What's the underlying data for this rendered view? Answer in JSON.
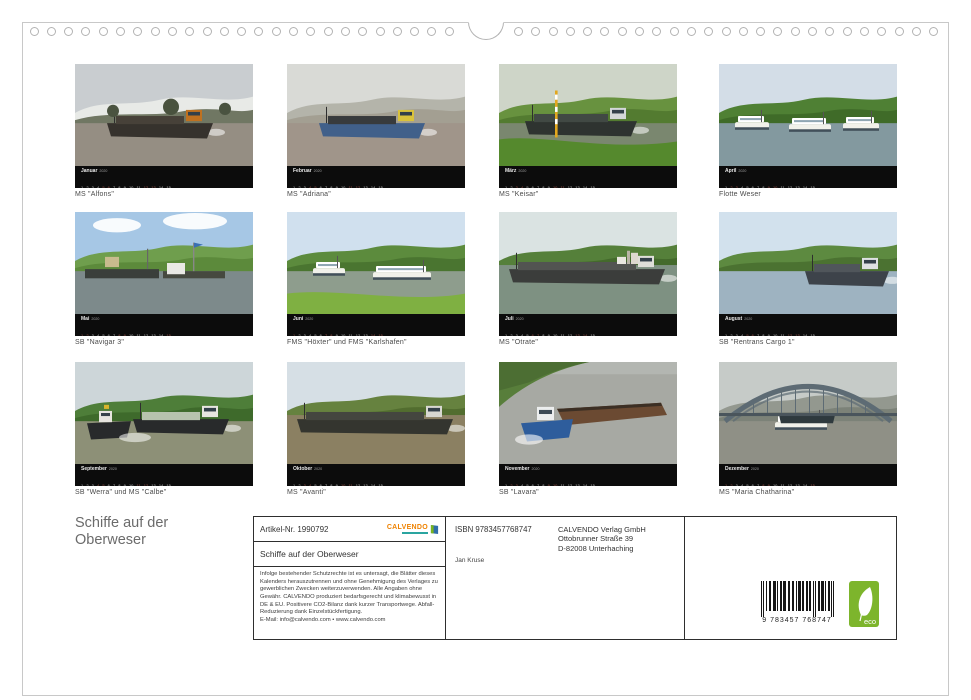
{
  "page": {
    "title_line1": "Schiffe auf der",
    "title_line2": "Oberweser"
  },
  "calendar": {
    "year": "2020"
  },
  "thumbnails": [
    {
      "month": "Januar",
      "caption": "MS \"Alfons\"",
      "type": "ship",
      "extra": "trees",
      "sky": "#c9cdd0",
      "hill": "#e8eae7",
      "hill2": "#707763",
      "water": "#958e83",
      "hull": "#36322d",
      "cab": "#bf7120",
      "cargo": "#474139"
    },
    {
      "month": "Februar",
      "caption": "MS \"Adriana\"",
      "type": "ship",
      "sky": "#d9dad6",
      "hill": "#b4b4aa",
      "hill2": "#a39f92",
      "water": "#a0958a",
      "hull": "#41608a",
      "cab": "#d9c23b",
      "cargo": "#383b3d"
    },
    {
      "month": "März",
      "caption": "MS \"Keisar\"",
      "type": "pole",
      "sky": "#ced5c8",
      "hill": "#68923f",
      "hill2": "#537b30",
      "water": "#7a876f",
      "hull": "#2e3330",
      "cab": "#d3d7d8",
      "cargo": "#414944",
      "fg": "#55892d"
    },
    {
      "month": "April",
      "caption": "Flotte Weser",
      "type": "white",
      "sky": "#d3dde7",
      "hill": "#4f8034",
      "hill2": "#3f6b28",
      "water": "#83999f",
      "hull": "#f0f0ea",
      "cab": "#ffffff",
      "cargo": "#d9d4c6"
    },
    {
      "month": "Mai",
      "caption": "SB \"Navigar 3\"",
      "type": "pontoon",
      "sky": "#a6c7e5",
      "hill": "#6f9e4d",
      "hill2": "#5c8a3b",
      "water": "#7d8a8b",
      "hull": "#3a3f3b",
      "cab": "#e9e9e4",
      "cargo": "#8a6f3f"
    },
    {
      "month": "Juni",
      "caption": "FMS \"Höxter\" und FMS \"Karlshafen\"",
      "type": "two",
      "sky": "#d0e0ee",
      "hill": "#5c8b3d",
      "hill2": "#4a7530",
      "water": "#8e9d8d",
      "hull": "#eae9e1",
      "cab": "#f4f4ee",
      "cargo": "#b7b19a",
      "fg": "#7fb042"
    },
    {
      "month": "Juli",
      "caption": "MS \"Otrate\"",
      "type": "long",
      "extra": "buildings",
      "sky": "#dae3e2",
      "hill": "#55803a",
      "hill2": "#446a2c",
      "water": "#7e9182",
      "hull": "#3b3d3b",
      "cab": "#dfdfd9",
      "cargo": "#525451"
    },
    {
      "month": "August",
      "caption": "SB \"Rentrans Cargo 1\"",
      "type": "shipRight",
      "sky": "#d2e1ed",
      "hill": "#5d8a40",
      "hill2": "#4b7231",
      "water": "#9eb3c1",
      "hull": "#3d434a",
      "cab": "#dde1e2",
      "cargo": "#50565b"
    },
    {
      "month": "September",
      "caption": "SB \"Werra\" und MS \"Calbe\"",
      "type": "tugship",
      "sky": "#cdd6d9",
      "hill": "#4e7e39",
      "hill2": "#3e6a2b",
      "water": "#8d9077",
      "hull": "#282a2b",
      "cab": "#e7e5df",
      "cargo": "#b7c3ae"
    },
    {
      "month": "Oktober",
      "caption": "MS \"Avanti\"",
      "type": "long",
      "sky": "#d6dfe5",
      "hill": "#66823f",
      "hill2": "#526d2f",
      "water": "#8b8062",
      "hull": "#34352f",
      "cab": "#d8d8d1",
      "cargo": "#44463f"
    },
    {
      "month": "November",
      "caption": "SB \"Lavara\"",
      "type": "tugbarge",
      "sky": "#b3b6b1",
      "hill": "#587e3b",
      "hill2": "#4c6e33",
      "water": "#a7a9a3",
      "hull": "#2e5d9c",
      "cab": "#eceeee",
      "cargo": "#6b4a32"
    },
    {
      "month": "Dezember",
      "caption": "MS \"Maria Chatharina\"",
      "type": "bridge",
      "sky": "#c6cbc8",
      "hill": "#93988f",
      "hill2": "#7c8278",
      "water": "#8f9086",
      "hull": "#3a3d3a",
      "cab": "#e9e9e3",
      "cargo": "#323d41",
      "bridge": "#5d6b74"
    }
  ],
  "info_box": {
    "artikel": "Artikel-Nr. 1990792",
    "calvendo_logo": "CALVENDO",
    "title": "Schiffe auf der Oberweser",
    "legal": "Infolge bestehender Schutzrechte ist es untersagt, die Blätter dieses Kalenders herauszutrennen und ohne Genehmigung des Verlages zu gewerblichen Zwecken weiterzuverwenden. Alle Angaben ohne Gewähr. CALVENDO produziert bedarfsgerecht und klimabewusst in DE & EU. Positivere CO2-Bilanz dank kurzer Transportwege. Abfall-Reduzierung dank Einzelstückfertigung.",
    "email": "E-Mail: info@calvendo.com • www.calvendo.com"
  },
  "publisher_box": {
    "isbn": "ISBN 9783457768747",
    "author": "Jan Kruse",
    "name": "CALVENDO Verlag GmbH",
    "street": "Ottobrunner Straße 39",
    "city": "D-82008 Unterhaching"
  },
  "barcode": {
    "digits": "9 783457 768747"
  },
  "eco_badge": {
    "label": "eco"
  },
  "colors": {
    "calvendo_orange": "#ef8200",
    "calvendo_teal": "#2aa5a0",
    "eco_green": "#7db52c",
    "strip_black": "#0c0c0c"
  }
}
